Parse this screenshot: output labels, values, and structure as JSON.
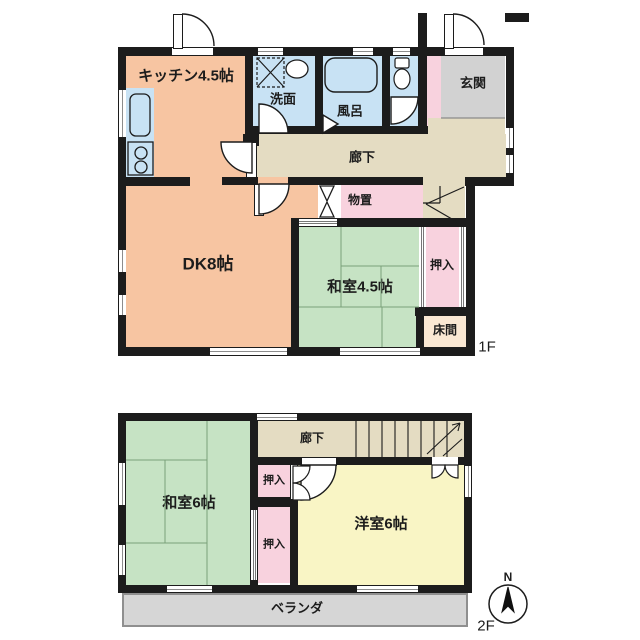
{
  "title": "2-story house floor plan",
  "floor1": {
    "label": "1F",
    "kitchen": "キッチン4.5帖",
    "washroom": "洗面",
    "bath": "風呂",
    "entrance": "玄関",
    "corridor": "廊下",
    "storage": "物置",
    "dining_kitchen": "DK8帖",
    "japanese_room": "和室4.5帖",
    "closet": "押入",
    "tokonoma": "床間"
  },
  "floor2": {
    "label": "2F",
    "corridor": "廊下",
    "japanese_room": "和室6帖",
    "closet_upper": "押入",
    "closet_lower": "押入",
    "western_room": "洋室6帖",
    "veranda": "ベランダ"
  },
  "compass": {
    "north": "N"
  },
  "colors": {
    "wall": "#1c1c1c",
    "kitchen_dk": "#f7c5a2",
    "wet_area": "#c8e2f4",
    "entrance": "#d2d2d2",
    "corridor": "#e4dcc2",
    "storage_closet": "#f8d2de",
    "tatami": "#c6e3c4",
    "tokonoma": "#fae8d3",
    "western_room": "#f9f5c5",
    "veranda": "#d6d6d6"
  }
}
